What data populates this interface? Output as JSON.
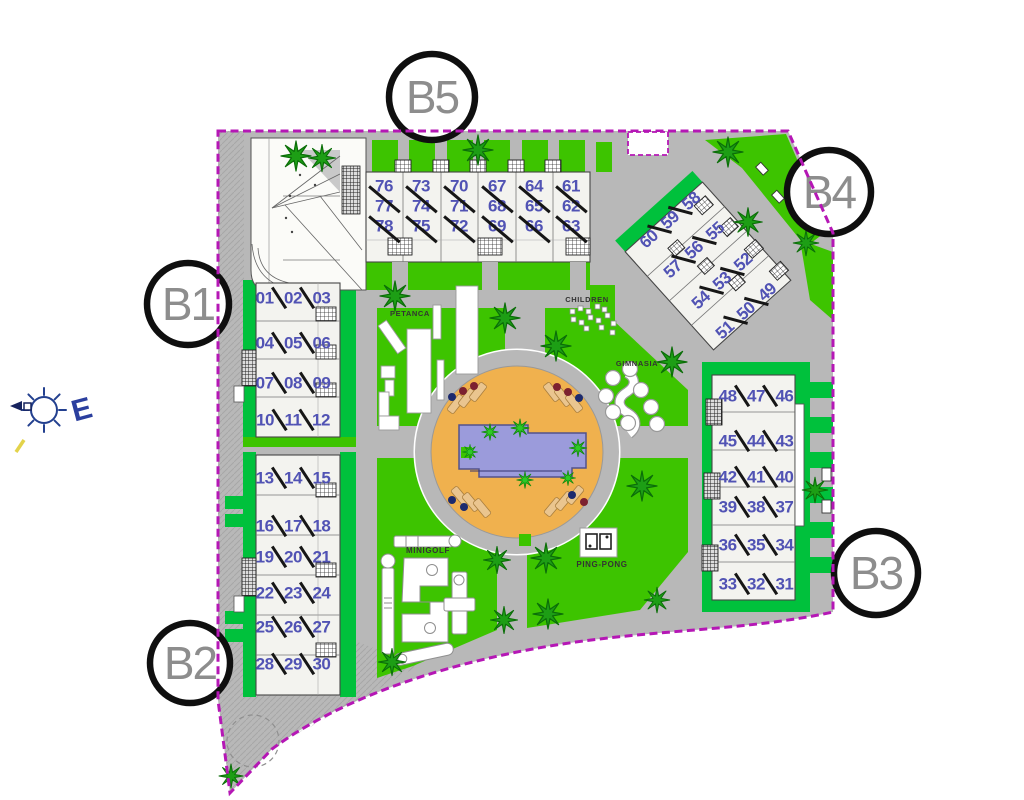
{
  "title": "Residential complex site plan",
  "compass": {
    "east_label": "E"
  },
  "block_markers": [
    {
      "label": "B1"
    },
    {
      "label": "B2"
    },
    {
      "label": "B3"
    },
    {
      "label": "B4"
    },
    {
      "label": "B5"
    }
  ],
  "amenity_labels": [
    {
      "label": "PETANCA"
    },
    {
      "label": "CHILDREN"
    },
    {
      "label": "GIMNASIA"
    },
    {
      "label": "MINIGOLF"
    },
    {
      "label": "PING-PONG"
    }
  ],
  "colors": {
    "boundary": "#b517b5",
    "road": "#b8b8b8",
    "lawn": "#3dc400",
    "strip_green": "#00c13c",
    "tree": "#1d9e15",
    "palm": "#2ec926",
    "pool_water": "#9b9bdb",
    "pool_deck": "#f0b14e",
    "building": "#f3f3ef",
    "unit_number": "#5153b4"
  },
  "unit_groups": [
    {
      "x": 384,
      "y": 206,
      "o": "v",
      "units": [
        "76",
        "77",
        "78"
      ]
    },
    {
      "x": 421,
      "y": 206,
      "o": "v",
      "units": [
        "73",
        "74",
        "75"
      ]
    },
    {
      "x": 459,
      "y": 206,
      "o": "v",
      "units": [
        "70",
        "71",
        "72"
      ]
    },
    {
      "x": 497,
      "y": 206,
      "o": "v",
      "units": [
        "67",
        "68",
        "69"
      ]
    },
    {
      "x": 534,
      "y": 206,
      "o": "v",
      "units": [
        "64",
        "65",
        "66"
      ]
    },
    {
      "x": 571,
      "y": 206,
      "o": "v",
      "units": [
        "61",
        "62",
        "63"
      ]
    },
    {
      "x": 670,
      "y": 220,
      "o": "h",
      "rot": -42,
      "units": [
        "60",
        "59",
        "58"
      ]
    },
    {
      "x": 694,
      "y": 250,
      "o": "h",
      "rot": -42,
      "units": [
        "57",
        "56",
        "55"
      ]
    },
    {
      "x": 722,
      "y": 281,
      "o": "h",
      "rot": -42,
      "units": [
        "54",
        "53",
        "52"
      ]
    },
    {
      "x": 746,
      "y": 311,
      "o": "h",
      "rot": -42,
      "units": [
        "51",
        "50",
        "49"
      ]
    },
    {
      "x": 293,
      "y": 298,
      "o": "h",
      "units": [
        "01",
        "02",
        "03"
      ]
    },
    {
      "x": 293,
      "y": 343,
      "o": "h",
      "units": [
        "04",
        "05",
        "06"
      ]
    },
    {
      "x": 293,
      "y": 383,
      "o": "h",
      "units": [
        "07",
        "08",
        "09"
      ]
    },
    {
      "x": 293,
      "y": 420,
      "o": "h",
      "units": [
        "10",
        "11",
        "12"
      ]
    },
    {
      "x": 293,
      "y": 478,
      "o": "h",
      "units": [
        "13",
        "14",
        "15"
      ]
    },
    {
      "x": 293,
      "y": 526,
      "o": "h",
      "units": [
        "16",
        "17",
        "18"
      ]
    },
    {
      "x": 293,
      "y": 557,
      "o": "h",
      "units": [
        "19",
        "20",
        "21"
      ]
    },
    {
      "x": 293,
      "y": 593,
      "o": "h",
      "units": [
        "22",
        "23",
        "24"
      ]
    },
    {
      "x": 293,
      "y": 627,
      "o": "h",
      "units": [
        "25",
        "26",
        "27"
      ]
    },
    {
      "x": 293,
      "y": 664,
      "o": "h",
      "units": [
        "28",
        "29",
        "30"
      ]
    },
    {
      "x": 756,
      "y": 396,
      "o": "h",
      "units": [
        "48",
        "47",
        "46"
      ]
    },
    {
      "x": 756,
      "y": 441,
      "o": "h",
      "units": [
        "45",
        "44",
        "43"
      ]
    },
    {
      "x": 756,
      "y": 477,
      "o": "h",
      "units": [
        "42",
        "41",
        "40"
      ]
    },
    {
      "x": 756,
      "y": 507,
      "o": "h",
      "units": [
        "39",
        "38",
        "37"
      ]
    },
    {
      "x": 756,
      "y": 545,
      "o": "h",
      "units": [
        "36",
        "35",
        "34"
      ]
    },
    {
      "x": 756,
      "y": 584,
      "o": "h",
      "units": [
        "33",
        "32",
        "31"
      ]
    }
  ]
}
